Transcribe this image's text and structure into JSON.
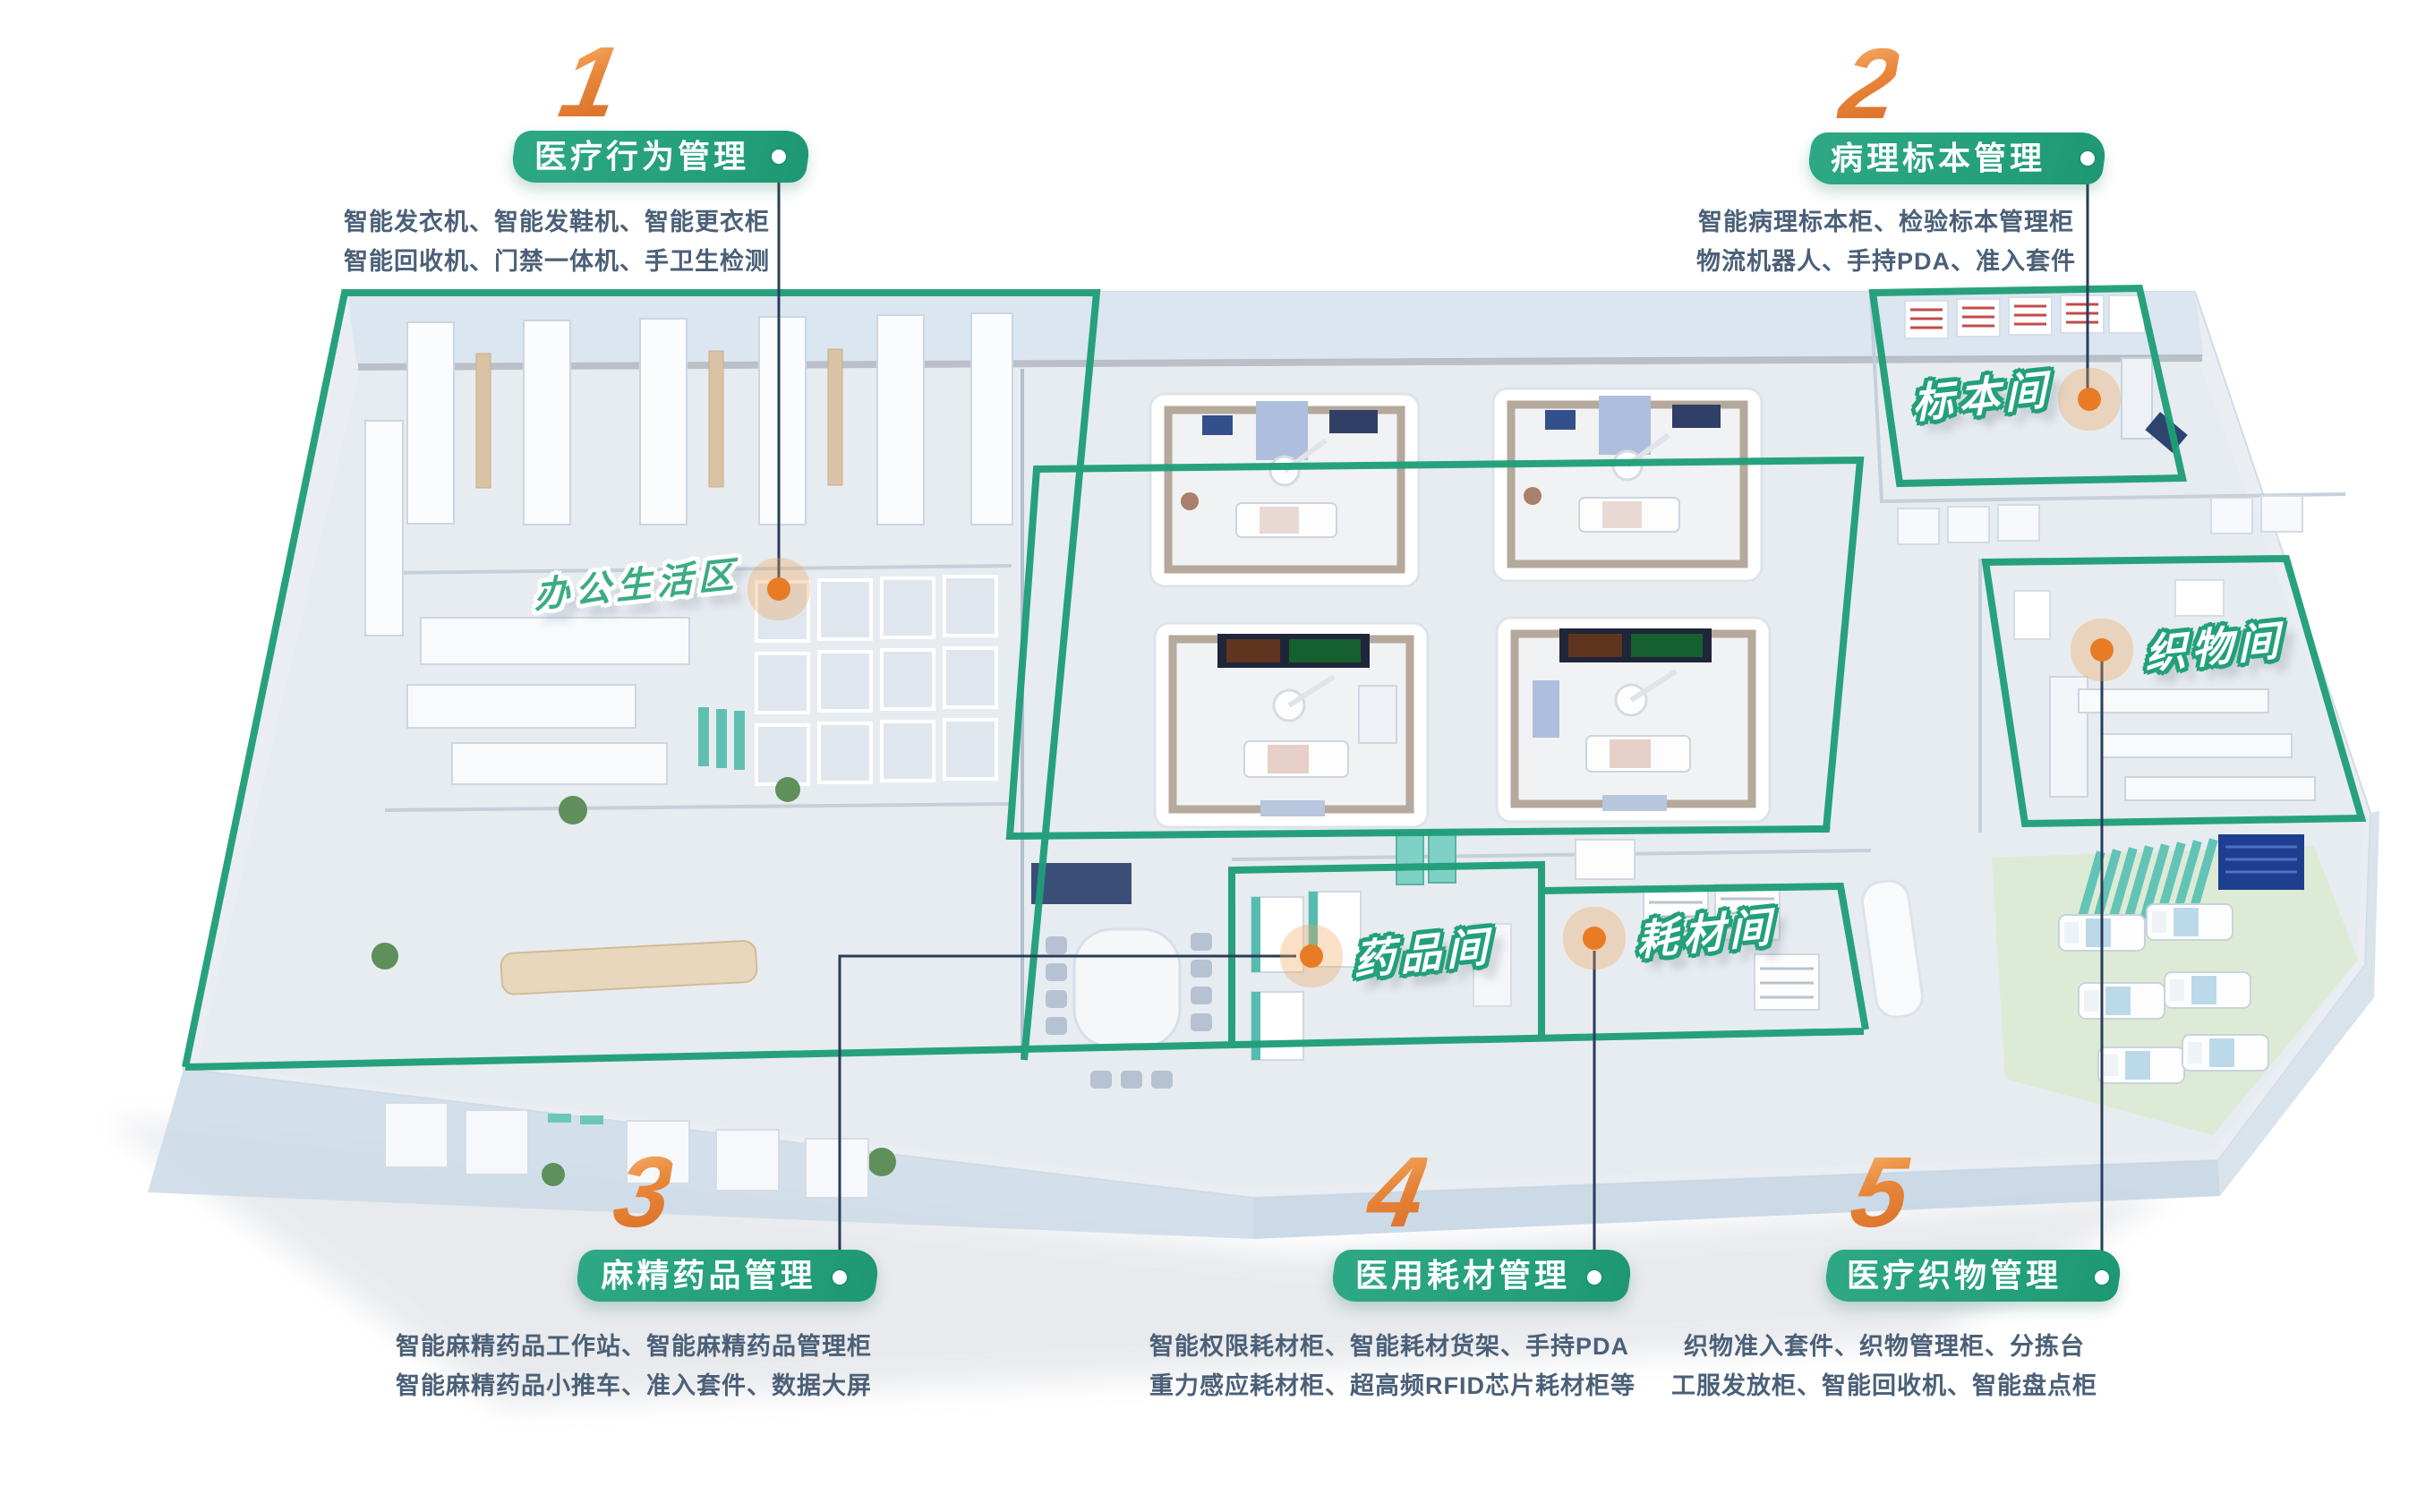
{
  "palette": {
    "green": "#23a07a",
    "orange": "#e87c25",
    "description_text": "#4b6078",
    "leader_line": "#2a3c58"
  },
  "sections": [
    {
      "number": "1",
      "title": "医疗行为管理",
      "desc_lines": [
        "智能发衣机、智能发鞋机、智能更衣柜",
        "智能回收机、门禁一体机、手卫生检测"
      ]
    },
    {
      "number": "2",
      "title": "病理标本管理",
      "desc_lines": [
        "智能病理标本柜、检验标本管理柜",
        "物流机器人、手持PDA、准入套件"
      ]
    },
    {
      "number": "3",
      "title": "麻精药品管理",
      "desc_lines": [
        "智能麻精药品工作站、智能麻精药品管理柜",
        "智能麻精药品小推车、准入套件、数据大屏"
      ]
    },
    {
      "number": "4",
      "title": "医用耗材管理",
      "desc_lines": [
        "智能权限耗材柜、智能耗材货架、手持PDA",
        "重力感应耗材柜、超高频RFID芯片耗材柜等"
      ]
    },
    {
      "number": "5",
      "title": "医疗织物管理",
      "desc_lines": [
        "织物准入套件、织物管理柜、分拣台",
        "工服发放柜、智能回收机、智能盘点柜"
      ]
    }
  ],
  "rooms": [
    {
      "name": "办公生活区"
    },
    {
      "name": "标本间"
    },
    {
      "name": "织物间"
    },
    {
      "name": "药品间"
    },
    {
      "name": "耗材间"
    }
  ]
}
